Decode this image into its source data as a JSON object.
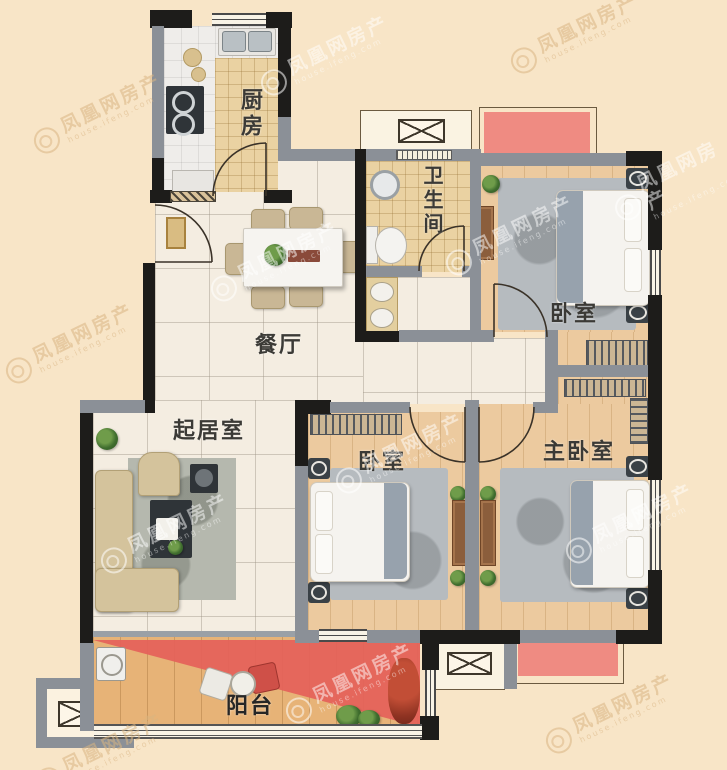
{
  "watermark": {
    "text": "凤凰网房产",
    "subtext": "house.ifeng.com"
  },
  "rooms": {
    "kitchen": {
      "label": "厨房"
    },
    "bathroom": {
      "label": "卫生间"
    },
    "bedroom_top": {
      "label": "卧室"
    },
    "bedroom_middle": {
      "label": "卧室"
    },
    "master_bedroom": {
      "label": "主卧室"
    },
    "dining_room": {
      "label": "餐厅"
    },
    "living_room": {
      "label": "起居室"
    },
    "balcony": {
      "label": "阳台"
    }
  },
  "colors": {
    "background": "#f8e5c7",
    "wall_black": "#1d1c1a",
    "wall_gray": "#8b9097",
    "balcony_highlight_red": "#e4615a",
    "platform_pink": "#ef8b82",
    "marble_floor": "#f4ede1",
    "wood_floor": "#ecca9f",
    "balcony_wood": "#e7b377",
    "bathroom_tile": "#ead2a2"
  }
}
